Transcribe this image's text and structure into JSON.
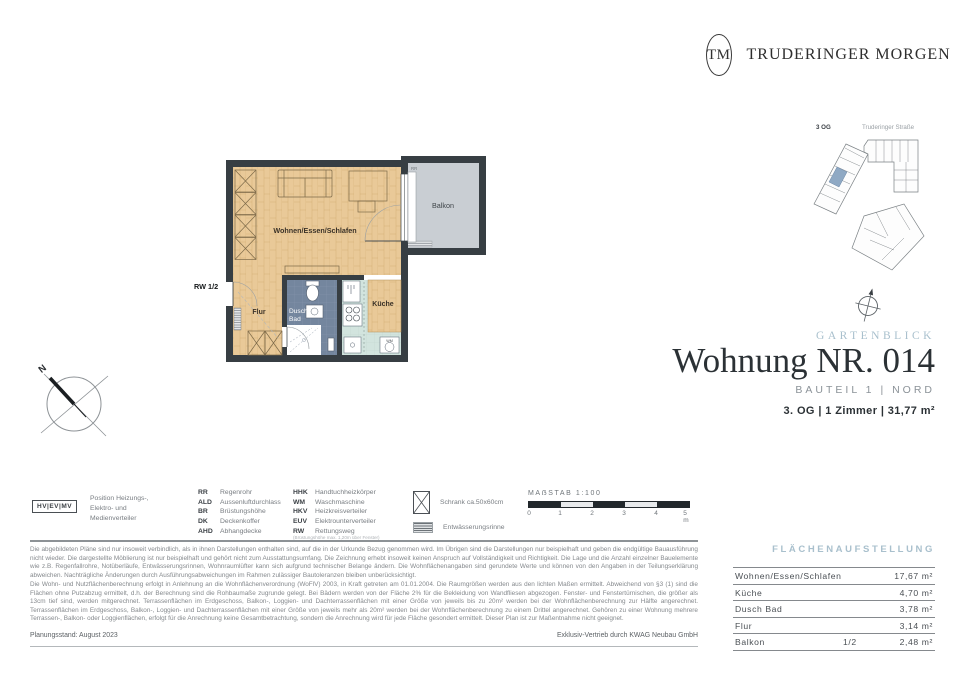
{
  "brand": {
    "initials": "TM",
    "name": "TRUDERINGER MORGEN"
  },
  "site_plan": {
    "floor_label": "3 OG",
    "street_label": "Truderinger Straße"
  },
  "title_block": {
    "project": "GARTENBLICK",
    "title": "Wohnung NR. 014",
    "subtitle": "BAUTEIL 1 | NORD",
    "details": "3. OG | 1 Zimmer | 31,77 m²"
  },
  "floor_plan": {
    "rooms": {
      "living": "Wohnen/Essen/Schlafen",
      "balcony": "Balkon",
      "hall": "Flur",
      "bath_line1": "Dusch",
      "bath_line2": "Bad",
      "kitchen": "Küche"
    },
    "annotations": {
      "rw": "RW 1/2",
      "rr": "RR",
      "wm": "WM",
      "north": "N"
    }
  },
  "legend": {
    "distributor_box": "HV|EV|MV",
    "distributor_text": "Position Heizungs-, Elektro- und Medienverteiler",
    "col1": [
      {
        "abbr": "RR",
        "label": "Regenrohr"
      },
      {
        "abbr": "ALD",
        "label": "Aussenluftdurchlass"
      },
      {
        "abbr": "BR",
        "label": "Brüstungshöhe"
      },
      {
        "abbr": "DK",
        "label": "Deckenkoffer"
      },
      {
        "abbr": "AHD",
        "label": "Abhangdecke"
      }
    ],
    "col2": [
      {
        "abbr": "HHK",
        "label": "Handtuchheizkörper"
      },
      {
        "abbr": "WM",
        "label": "Waschmaschine"
      },
      {
        "abbr": "HKV",
        "label": "Heizkreisverteiler"
      },
      {
        "abbr": "EUV",
        "label": "Elektrounterverteiler"
      },
      {
        "abbr": "RW",
        "label": "Rettungsweg",
        "note": "(Brüstungshöhe max. 1,20m über Fenster)"
      }
    ],
    "symbols": [
      {
        "icon": "schrank-box",
        "label": "Schrank ca.50x60cm"
      },
      {
        "icon": "drain-hatch",
        "label": "Entwässerungsrinne"
      }
    ],
    "scale": {
      "title": "MAẞSTAB 1:100",
      "ticks": [
        "0",
        "1",
        "2",
        "3",
        "4",
        "5 m"
      ]
    }
  },
  "disclaimer": {
    "paragraph1": "Die abgebildeten Pläne sind nur insoweit verbindlich, als in ihnen Darstellungen enthalten sind, auf die in der Urkunde Bezug genommen wird. Im Übrigen sind die Darstellungen nur beispielhaft und geben die endgültige Bauausführung nicht wieder. Die dargestellte Möblierung ist nur beispielhaft und gehört nicht zum Ausstattungsumfang. Die Zeichnung erhebt insoweit keinen Anspruch auf Vollständigkeit und Richtigkeit. Die Lage und die Anzahl einzelner Bauelemente wie z.B. Regenfallrohre, Notüberläufe, Entwässerungsrinnen, Wohnraumlüfter kann sich aufgrund technischer Belange ändern. Die Wohnflächenangaben sind gerundete Werte und können von den Angaben in der Teilungserklärung abweichen. Nachträgliche Änderungen durch Ausführungsabweichungen im Rahmen zulässiger Bautoleranzen bleiben unberücksichtigt.",
    "paragraph2": "Die Wohn- und Nutzflächenberechnung erfolgt in Anlehnung an die Wohnflächenverordnung (WoFlV) 2003, in Kraft getreten am 01.01.2004. Die Raumgrößen werden aus den lichten Maßen ermittelt. Abweichend von §3 (1) sind die Flächen ohne Putzabzug ermittelt, d.h. der Berechnung sind die Rohbaumaße zugrunde gelegt. Bei Bädern werden von der Fläche 2% für die Bekleidung von Wandfliesen abgezogen. Fenster- und Fenstertürnischen, die größer als 13cm tief sind, werden mitgerechnet. Terrassenflächen im Erdgeschoss, Balkon-, Loggien- und Dachterrassenflächen mit einer Größe von jeweils bis zu 20m² werden bei der Wohnflächenberechnung zur Hälfte angerechnet. Terrassenflächen im Erdgeschoss, Balkon-, Loggien- und Dachterrassenflächen mit einer Größe von jeweils mehr als 20m² werden bei der Wohnflächenberechnung zu einem Drittel angerechnet. Gehören zu einer Wohnung mehrere Terrassen-, Balkon- oder Loggienflächen, erfolgt für die Anrechnung keine Gesamtbetrachtung, sondern die Anrechnung wird für jede Fläche gesondert ermittelt. Dieser Plan ist zur Maßentnahme nicht geeignet."
  },
  "footer": {
    "left": "Planungsstand: August 2023",
    "right": "Exklusiv-Vertrieb durch KWAG Neubau GmbH"
  },
  "area_table": {
    "heading": "FLÄCHENAUFSTELLUNG",
    "rows": [
      {
        "room": "Wohnen/Essen/Schlafen",
        "factor": "",
        "area": "17,67 m²"
      },
      {
        "room": "Küche",
        "factor": "",
        "area": "4,70 m²"
      },
      {
        "room": "Dusch Bad",
        "factor": "",
        "area": "3,78 m²"
      },
      {
        "room": "Flur",
        "factor": "",
        "area": "3,14 m²"
      },
      {
        "room": "Balkon",
        "factor": "1/2",
        "area": "2,48 m²"
      }
    ]
  },
  "colors": {
    "accent_blue": "#a9c0cd",
    "wall": "#373e43",
    "wood": "#e9c998",
    "bath": "#74869e",
    "kitchen": "#d2e4de",
    "balcony": "#c9ced3",
    "unit_highlight": "#8fa9c4"
  }
}
